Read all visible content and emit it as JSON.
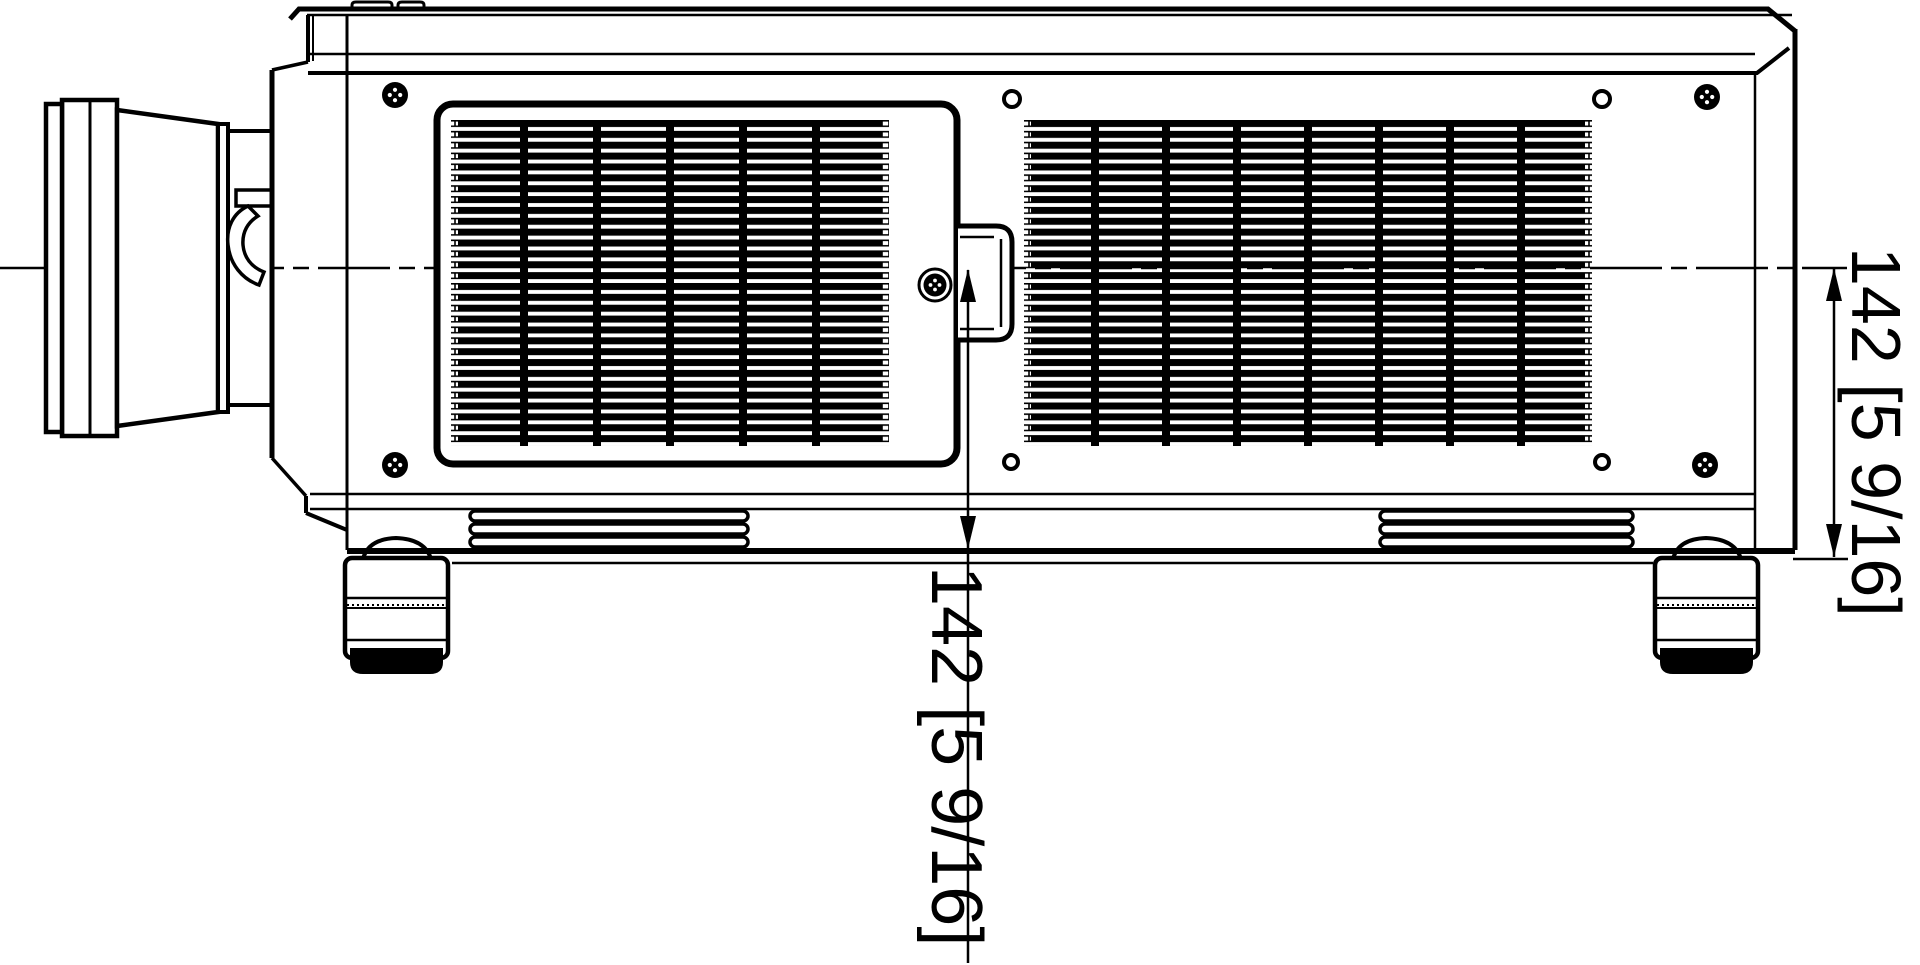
{
  "page": {
    "background": "#ffffff",
    "ink": "#000000",
    "drawing_type": "technical-dimension-drawing"
  },
  "dimensions": {
    "mid": {
      "label": "142 [5 9/16]",
      "value_mm": 142,
      "value_inches": "5 9/16"
    },
    "right": {
      "label": "142 [5 9/16]",
      "value_mm": 142,
      "value_inches": "5 9/16"
    }
  }
}
